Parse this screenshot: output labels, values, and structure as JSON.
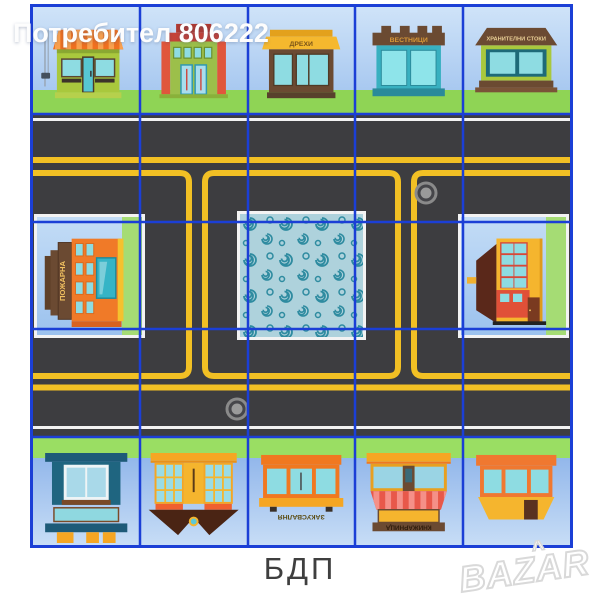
{
  "watermark": "Потребител 806222",
  "caption": "БДП",
  "marketplace_logo": "BAZAR",
  "board": {
    "rows": 5,
    "cols": 5,
    "description": "children road-safety play mat with buildings, roads and center ornament"
  },
  "buildings": {
    "top": [
      {
        "name": "awning-shop",
        "label": ""
      },
      {
        "name": "town-hall",
        "label": ""
      },
      {
        "name": "clothes-shop",
        "label": "ДРЕХИ"
      },
      {
        "name": "newsstand",
        "label": "ВЕСТНИЦИ"
      },
      {
        "name": "grocery-store",
        "label": "ХРАНИТЕЛНИ СТОКИ"
      }
    ],
    "middle_left": {
      "name": "fire-station",
      "label": "ПОЖАРНА"
    },
    "middle_right": {
      "name": "corner-house",
      "label": ""
    },
    "bottom": [
      {
        "name": "teal-house",
        "label": ""
      },
      {
        "name": "bay-window-house",
        "label": ""
      },
      {
        "name": "snack-bar",
        "label": "ЗАКУСВАЛНЯ"
      },
      {
        "name": "bookstore",
        "label": "КНИЖАРНИЦА"
      },
      {
        "name": "orange-kiosk",
        "label": ""
      }
    ]
  },
  "colors": {
    "grid_blue": "#1b3fd6",
    "asphalt": "#3d3d40",
    "lane_yellow": "#f2c024",
    "lane_white": "#f2f2f2",
    "grass_green": "#8fd455",
    "sky_blue": "#bcd7f5",
    "swirl_teal": "#2e8ba0",
    "swirl_bg": "#aed2dc"
  }
}
